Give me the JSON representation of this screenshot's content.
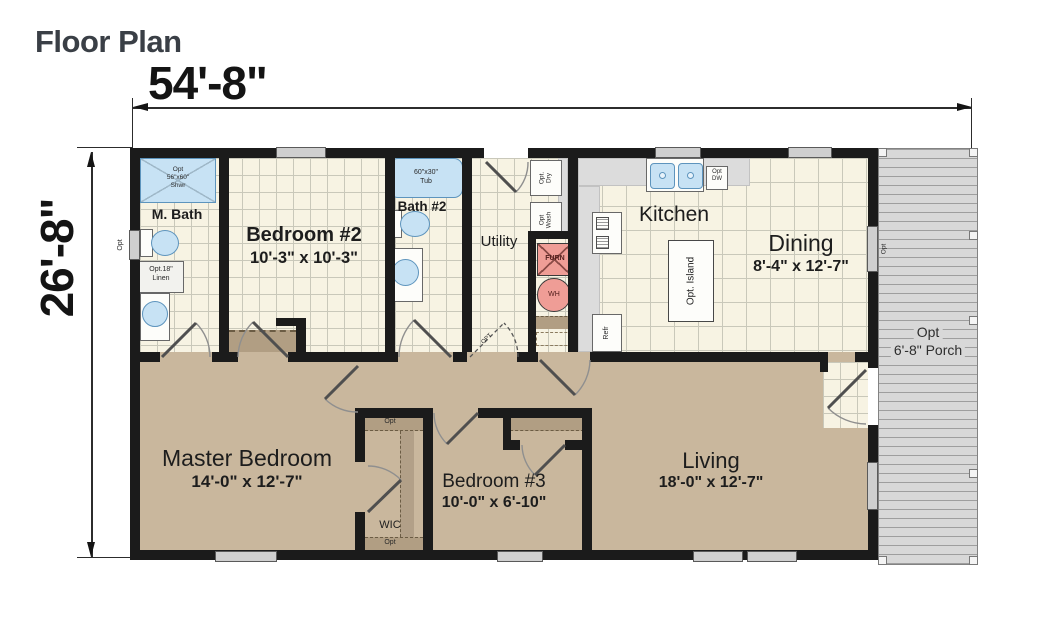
{
  "title": "Floor Plan",
  "dimensions": {
    "width": "54'-8\"",
    "height": "26'-8\""
  },
  "rooms": {
    "m_bath": {
      "name": "M. Bath"
    },
    "bedroom2": {
      "name": "Bedroom #2",
      "size": "10'-3\" x 10'-3\""
    },
    "bath2": {
      "name": "Bath #2"
    },
    "utility": {
      "name": "Utility"
    },
    "kitchen": {
      "name": "Kitchen"
    },
    "dining": {
      "name": "Dining",
      "size": "8'-4\" x 12'-7\""
    },
    "master_bedroom": {
      "name": "Master Bedroom",
      "size": "14'-0\" x 12'-7\""
    },
    "bedroom3": {
      "name": "Bedroom #3",
      "size": "10'-0\" x 6'-10\""
    },
    "wic": {
      "name": "WIC"
    },
    "living": {
      "name": "Living",
      "size": "18'-0\" x 12'-7\""
    },
    "porch": {
      "line1": "Opt",
      "line2": "6'-8\" Porch"
    }
  },
  "fixtures": {
    "shower": {
      "line1": "Opt",
      "line2": "56\"x60\"",
      "line3": "Shwr"
    },
    "tub": {
      "line1": "60\"x30\"",
      "line2": "Tub"
    },
    "linen": {
      "line1": "Opt.18\"",
      "line2": "Linen"
    },
    "dryer": {
      "line1": "Opt.",
      "line2": "Dry"
    },
    "washer": {
      "line1": "Opt",
      "line2": "Wash"
    },
    "furnace": {
      "label": "FURN"
    },
    "water_heater": {
      "label": "WH"
    },
    "refrigerator": {
      "label": "Refr"
    },
    "island": {
      "label": "Opt. Island"
    },
    "dishwasher": {
      "line1": "Opt",
      "line2": "DW"
    },
    "opt_window_left": {
      "label": "Opt"
    },
    "opt_window_right": {
      "label": "Opt"
    },
    "opt_door": {
      "label": "OPT"
    },
    "wic_shelf_top": {
      "label": "Opt"
    },
    "wic_shelf_bottom": {
      "label": "Opt"
    }
  },
  "colors": {
    "wall": "#1b1b1b",
    "tile_floor": "#f7f3e3",
    "carpet": "#c9b79d",
    "fixture_blue": "#c7e2f4",
    "fixture_red": "#ef9d96",
    "porch": "#d8d8d8",
    "counter": "#dcdcdc",
    "shelf": "#b19e83",
    "title_text": "#3a3f46"
  }
}
